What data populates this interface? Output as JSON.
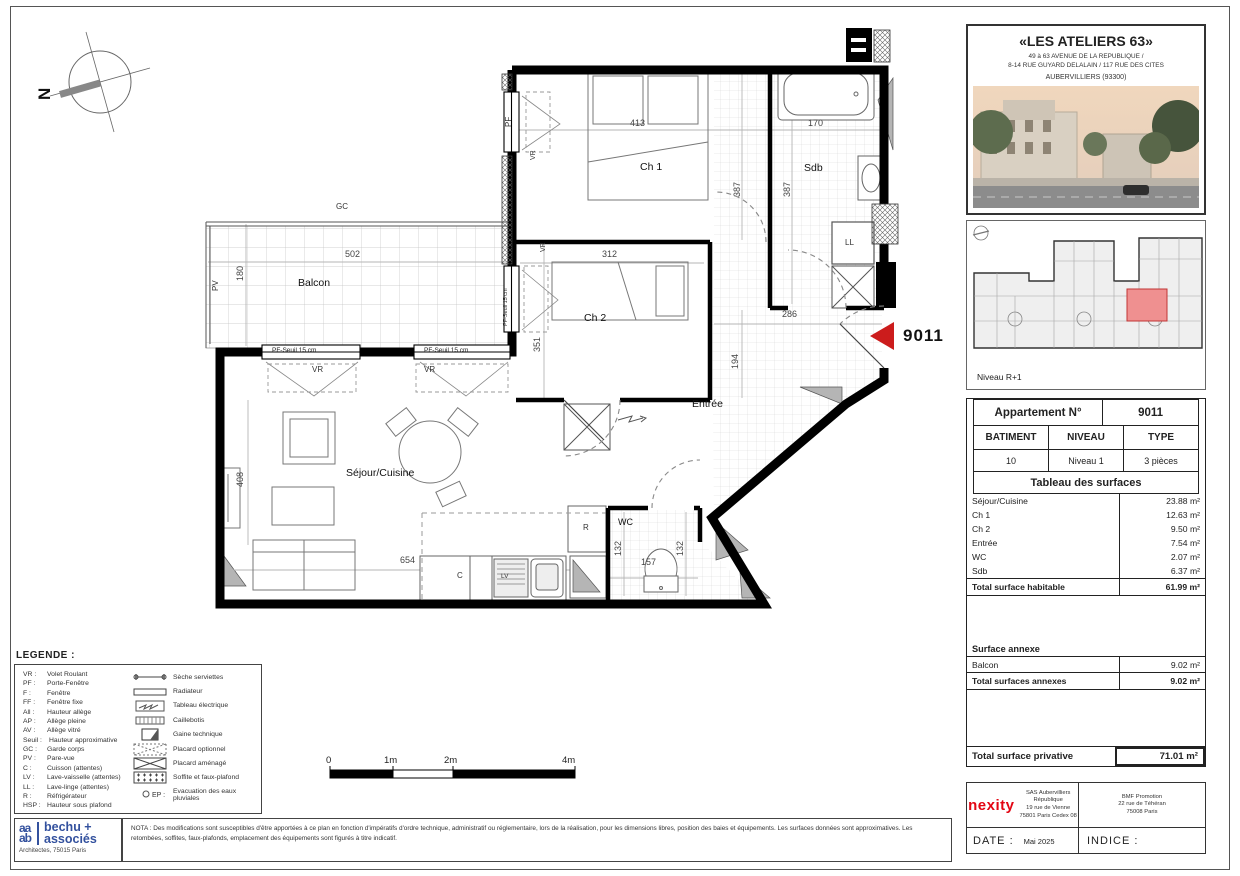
{
  "colors": {
    "marker_red": "#cc1c1c",
    "nexity_red": "#e30613",
    "bechu_blue": "#33519e",
    "keyplan_highlight": "#ef9090",
    "wall_black": "#000000"
  },
  "project": {
    "title": "«LES ATELIERS 63»",
    "address1": "49 à 63 AVENUE DE LA REPUBLIQUE /",
    "address2": "8-14 RUE GUYARD DELALAIN / 117 RUE DES CITES",
    "city": "AUBERVILLIERS (93300)",
    "keyplan_level": "Niveau R+1"
  },
  "apartment": {
    "card_label": "Appartement N°",
    "number": "9011",
    "col_headers": [
      "BATIMENT",
      "NIVEAU",
      "TYPE"
    ],
    "col_values": [
      "10",
      "Niveau 1",
      "3 pièces"
    ],
    "surfaces_title": "Tableau des surfaces",
    "surfaces": [
      {
        "room": "Séjour/Cuisine",
        "area": "23.88 m²"
      },
      {
        "room": "Ch 1",
        "area": "12.63 m²"
      },
      {
        "room": "Ch 2",
        "area": "9.50 m²"
      },
      {
        "room": "Entrée",
        "area": "7.54 m²"
      },
      {
        "room": "WC",
        "area": "2.07 m²"
      },
      {
        "room": "Sdb",
        "area": "6.37 m²"
      }
    ],
    "total_habitable_label": "Total surface habitable",
    "total_habitable_value": "61.99 m²",
    "annexe_title": "Surface annexe",
    "annexes": [
      {
        "room": "Balcon",
        "area": "9.02 m²"
      }
    ],
    "total_annexes_label": "Total surfaces annexes",
    "total_annexes_value": "9.02 m²",
    "total_privative_label": "Total surface privative",
    "total_privative_value": "71.01 m²"
  },
  "plan": {
    "marker": "9011",
    "north": "N",
    "rooms": {
      "ch1": "Ch 1",
      "ch2": "Ch 2",
      "sdb": "Sdb",
      "balcon": "Balcon",
      "sejour": "Séjour/Cuisine",
      "entree": "Entrée",
      "wc": "WC"
    },
    "dims": {
      "ch1_w": "413",
      "ch1_h": "387",
      "sdb_w": "170",
      "sdb_h": "387",
      "balcon_w": "502",
      "balcon_d": "180",
      "ch2_w": "312",
      "ch2_h": "351",
      "entree_w": "286",
      "entree_h": "194",
      "sejour_h": "408",
      "sejour_w": "654",
      "wc_left": "132",
      "wc_w": "157",
      "wc_right": "132"
    },
    "tags": {
      "gc": "GC",
      "pv": "PV",
      "pf": "PF",
      "vr": "VR",
      "pf_seuil": "PF-Seuil 15 cm",
      "ll": "LL",
      "r": "R",
      "c": "C",
      "lv": "LV"
    }
  },
  "legend": {
    "title": "LEGENDE :",
    "abbreviations": [
      {
        "abbr": "VR :",
        "label": "Volet Roulant"
      },
      {
        "abbr": "PF :",
        "label": "Porte-Fenêtre"
      },
      {
        "abbr": "F :",
        "label": "Fenêtre"
      },
      {
        "abbr": "FF :",
        "label": "Fenêtre fixe"
      },
      {
        "abbr": "All :",
        "label": "Hauteur allège"
      },
      {
        "abbr": "AP :",
        "label": "Allège pleine"
      },
      {
        "abbr": "AV :",
        "label": "Allège vitré"
      },
      {
        "abbr": "Seuil :",
        "label": "Hauteur approximative"
      },
      {
        "abbr": "GC :",
        "label": "Garde corps"
      },
      {
        "abbr": "PV :",
        "label": "Pare-vue"
      },
      {
        "abbr": "C :",
        "label": "Cuisson (attentes)"
      },
      {
        "abbr": "LV :",
        "label": "Lave-vaisselle (attentes)"
      },
      {
        "abbr": "LL :",
        "label": "Lave-linge (attentes)"
      },
      {
        "abbr": "R :",
        "label": "Réfrigérateur"
      },
      {
        "abbr": "HSP :",
        "label": "Hauteur sous plafond"
      }
    ],
    "symbols": [
      {
        "label": "Sèche serviettes"
      },
      {
        "label": "Radiateur"
      },
      {
        "label": "Tableau électrique"
      },
      {
        "label": "Caillebotis"
      },
      {
        "label": "Gaine technique"
      },
      {
        "label": "Placard optionnel"
      },
      {
        "label": "Placard aménagé"
      },
      {
        "label": "Soffite et faux-plafond"
      },
      {
        "abbr": "EP :",
        "label": "Evacuation des eaux pluviales"
      }
    ]
  },
  "scalebar": {
    "t0": "0",
    "t1": "1m",
    "t2": "2m",
    "t4": "4m"
  },
  "architect": {
    "monogram1": "aa",
    "monogram2": "ab",
    "name1": "bechu +",
    "name2": "associés",
    "sub": "Architectes, 75015 Paris"
  },
  "nota": "NOTA : Des modifications sont susceptibles d'être apportées à ce plan en fonction d'impératifs d'ordre technique, administratif ou réglementaire, lors de la réalisation, pour les dimensions libres, position des baies et équipements. Les surfaces données sont approximatives. Les retombées, soffites, faux-plafonds, emplacement des équipements sont figurés à titre indicatif.",
  "footer": {
    "brand": "nexity",
    "sas": [
      "SAS Aubervilliers",
      "République",
      "19 rue de Vienne",
      "75801 Paris Cedex 08"
    ],
    "bmf": [
      "BMF Promotion",
      "22 rue de Téhéran",
      "75008 Paris"
    ],
    "date_label": "DATE :",
    "date_value": "Mai 2025",
    "indice_label": "INDICE :"
  }
}
